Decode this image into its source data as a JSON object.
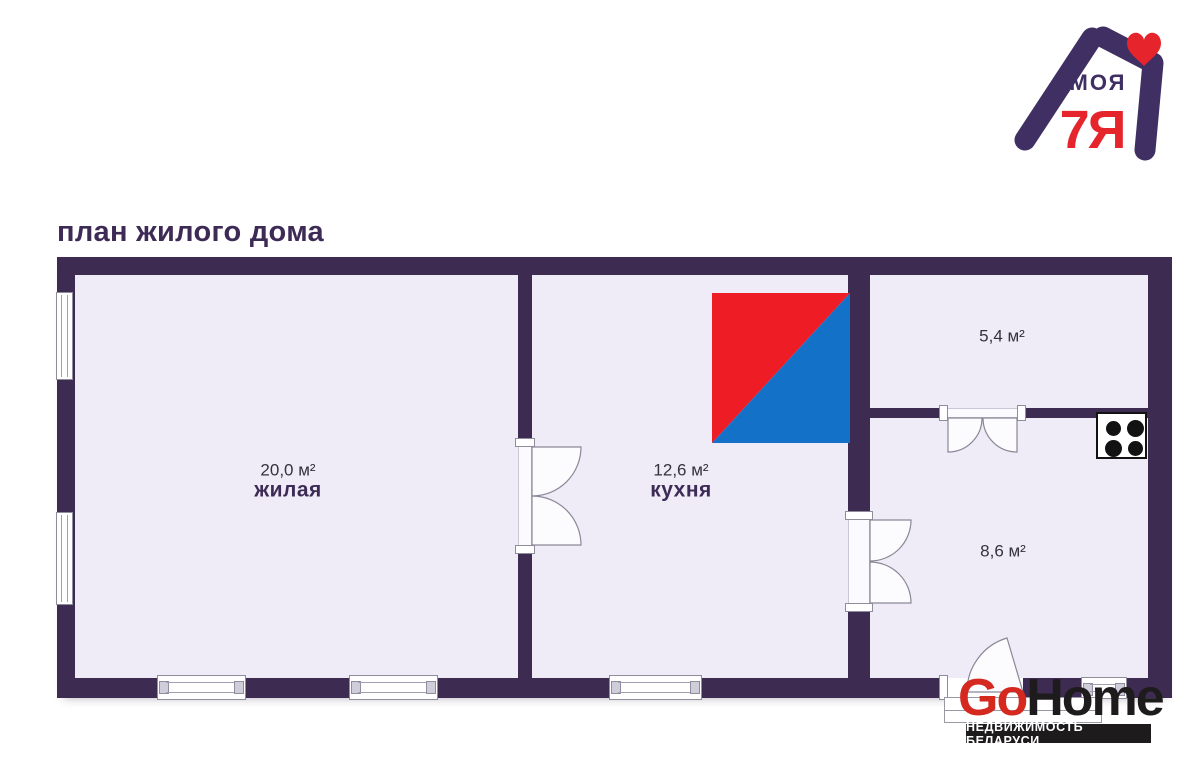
{
  "brand": {
    "text_moya": "МОЯ",
    "text_7ya": "7Я",
    "purple": "#3f2f63",
    "red": "#e5242c"
  },
  "page_title": "план жилого дома",
  "plan": {
    "wall_color": "#3d2b52",
    "floor_color": "#efecf7",
    "rooms": [
      {
        "area": "20,0 м²",
        "name": "жилая"
      },
      {
        "area": "12,6 м²",
        "name": "кухня"
      },
      {
        "area": "5,4 м²",
        "name": ""
      },
      {
        "area": "8,6 м²",
        "name": ""
      }
    ],
    "marker_red": "#ee1c25",
    "marker_blue": "#1371c8"
  },
  "watermark": {
    "go": "Go",
    "home": "Home",
    "tagline": "НЕДВИЖИМОСТЬ БЕЛАРУСИ",
    "red": "#d5281f",
    "bar_black": "#1d1b1c"
  }
}
